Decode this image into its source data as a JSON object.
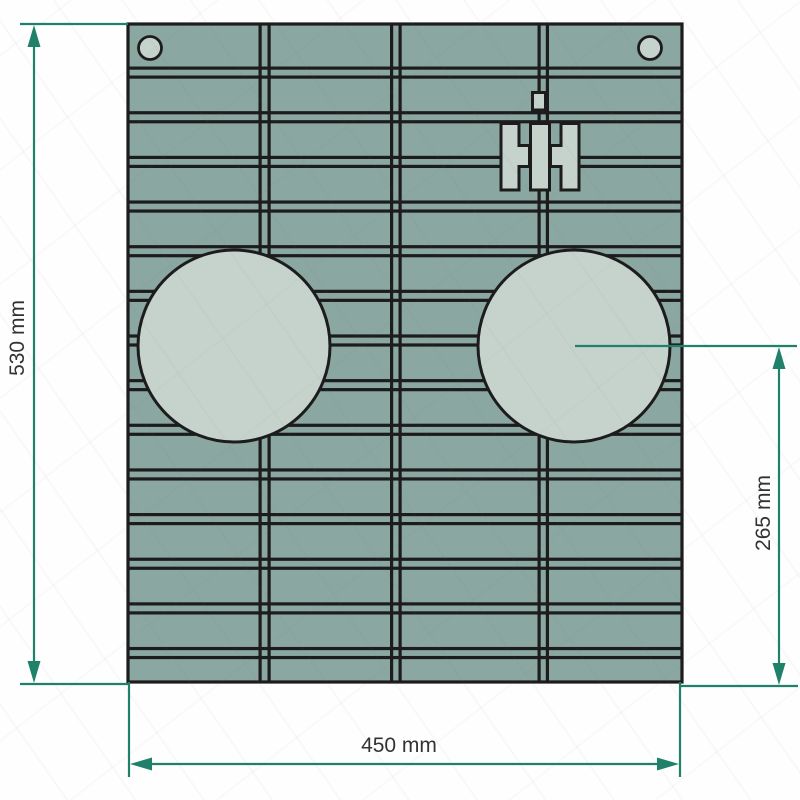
{
  "figure": {
    "type": "technical-drawing",
    "subject": "Ribbed front grille panel with two circular openings, two mounting holes and IH-style emblem",
    "units": "mm",
    "panel_width_mm": 450,
    "panel_height_mm": 530,
    "circle_center_to_bottom_mm": 265
  },
  "labels": {
    "height": "530 mm",
    "width": "450 mm",
    "center_height": "265 mm"
  },
  "colors": {
    "background": "#fefefe",
    "panel": "#8ba7a1",
    "panel_light": "#c6d3cd",
    "outline": "#1c1c1c",
    "dimension": "#1f8169",
    "label_text": "#333333"
  },
  "pattern": {
    "horizontal_slat_pairs": 14,
    "vertical_seams": 3,
    "big_circles": 2,
    "mounting_holes": 2
  }
}
